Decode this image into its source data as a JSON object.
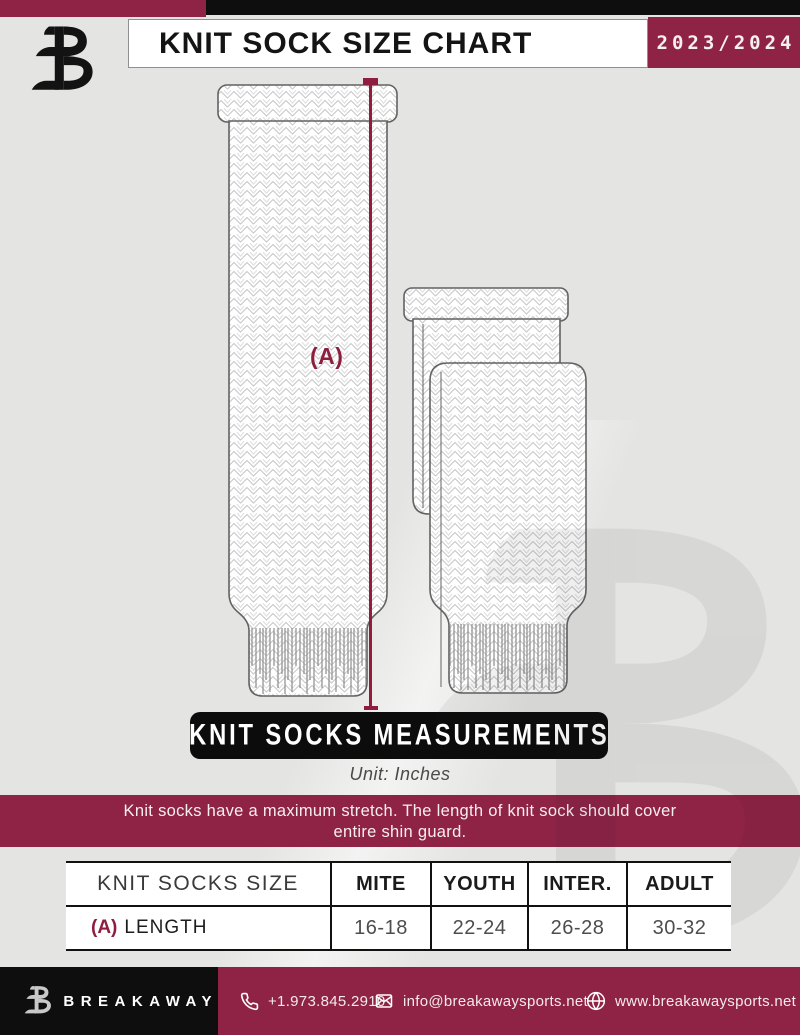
{
  "header": {
    "title": "KNIT SOCK SIZE CHART",
    "season": "2023/2024"
  },
  "diagram": {
    "length_label": "(A)",
    "banner": "KNIT SOCKS MEASUREMENTS",
    "unit": "Unit: Inches"
  },
  "notice": {
    "line1": "Knit socks have a maximum stretch. The length of knit sock should cover",
    "line2": "entire shin guard."
  },
  "table": {
    "headers": [
      "KNIT SOCKS SIZE",
      "MITE",
      "YOUTH",
      "INTER.",
      "ADULT"
    ],
    "row": {
      "key": "(A)",
      "label": "LENGTH",
      "values": [
        "16-18",
        "22-24",
        "26-28",
        "30-32"
      ]
    }
  },
  "footer": {
    "brand": "BREAKAWAY",
    "phone": "+1.973.845.2910",
    "email": "info@breakawaysports.net",
    "website": "www.breakawaysports.net"
  },
  "colors": {
    "maroon": "#8E2346",
    "black": "#0E0E0E",
    "background": "#E4E4E3",
    "accent_line": "#8E1D3E"
  }
}
